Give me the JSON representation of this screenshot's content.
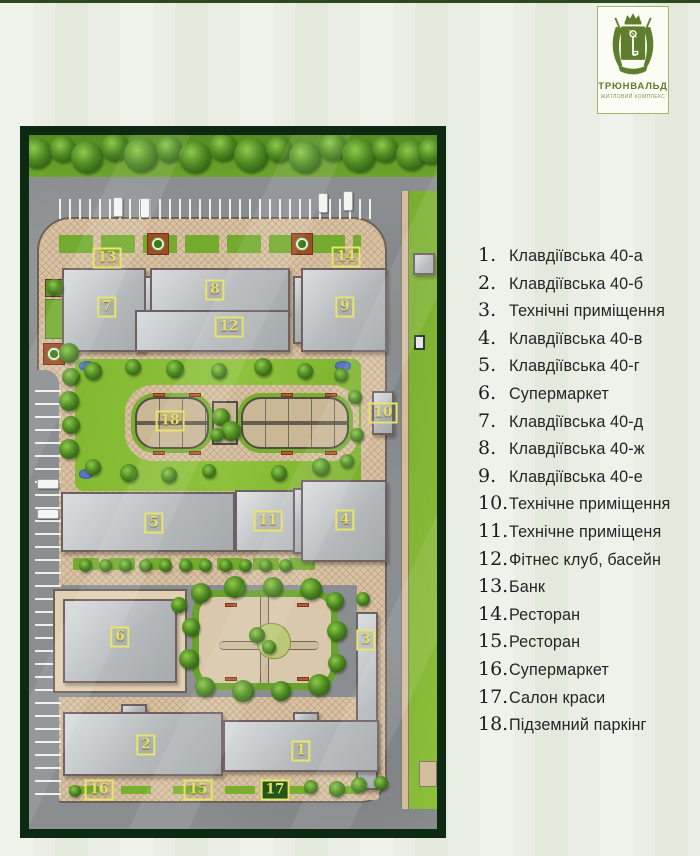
{
  "page": {
    "background": "#e9ede3",
    "top_line_color": "#2d4a1d"
  },
  "logo": {
    "title": "ТРЮНВАЛЬД",
    "subtitle": "ЖИТЛОВИЙ КОМПЛЕКС",
    "brand_color": "#5d7d2c",
    "crest_icon": "heraldic-crest-with-crown-and-key"
  },
  "map": {
    "frame_color": "#0d2912",
    "marker_color": "#e9e46a",
    "pavement_color": "#d8c2a3",
    "lawn_color": "#82b830",
    "road_color": "#8b8e90",
    "building_color": "#b8bcbe",
    "markers": [
      {
        "n": "1",
        "x": 272,
        "y": 616,
        "filled": false
      },
      {
        "n": "2",
        "x": 117,
        "y": 610,
        "filled": false
      },
      {
        "n": "3",
        "x": 337,
        "y": 505,
        "filled": false
      },
      {
        "n": "4",
        "x": 316,
        "y": 385,
        "filled": false
      },
      {
        "n": "5",
        "x": 125,
        "y": 388,
        "filled": false
      },
      {
        "n": "6",
        "x": 91,
        "y": 502,
        "filled": false
      },
      {
        "n": "7",
        "x": 78,
        "y": 172,
        "filled": false
      },
      {
        "n": "8",
        "x": 186,
        "y": 155,
        "filled": false
      },
      {
        "n": "9",
        "x": 316,
        "y": 172,
        "filled": false
      },
      {
        "n": "10",
        "x": 354,
        "y": 278,
        "filled": false
      },
      {
        "n": "11",
        "x": 239,
        "y": 386,
        "filled": false
      },
      {
        "n": "12",
        "x": 200,
        "y": 192,
        "filled": false
      },
      {
        "n": "13",
        "x": 78,
        "y": 123,
        "filled": false
      },
      {
        "n": "14",
        "x": 317,
        "y": 122,
        "filled": false
      },
      {
        "n": "15",
        "x": 169,
        "y": 655,
        "filled": false
      },
      {
        "n": "16",
        "x": 70,
        "y": 655,
        "filled": false
      },
      {
        "n": "17",
        "x": 246,
        "y": 655,
        "filled": true
      },
      {
        "n": "18",
        "x": 141,
        "y": 286,
        "filled": false
      }
    ]
  },
  "legend": {
    "items": [
      {
        "num": "1.",
        "label": "Клавдіївська 40-а"
      },
      {
        "num": "2.",
        "label": "Клавдіївська 40-б"
      },
      {
        "num": "3.",
        "label": "Технічні приміщення"
      },
      {
        "num": "4.",
        "label": "Клавдіївська 40-в"
      },
      {
        "num": "5.",
        "label": "Клавдіївська 40-г"
      },
      {
        "num": "6.",
        "label": "Супермаркет"
      },
      {
        "num": "7.",
        "label": "Клавдіївська 40-д"
      },
      {
        "num": "8.",
        "label": "Клавдіївська 40-ж"
      },
      {
        "num": "9.",
        "label": "Клавдіївська 40-е"
      },
      {
        "num": "10.",
        "label": "Технічне приміщення"
      },
      {
        "num": "11.",
        "label": "Технічне приміщеня"
      },
      {
        "num": "12.",
        "label": "Фітнес клуб, басейн"
      },
      {
        "num": "13.",
        "label": "Банк"
      },
      {
        "num": "14.",
        "label": "Ресторан"
      },
      {
        "num": "15.",
        "label": "Ресторан"
      },
      {
        "num": "16.",
        "label": "Супермаркет"
      },
      {
        "num": "17.",
        "label": "Салон краси"
      },
      {
        "num": "18.",
        "label": "Підземний паркінг"
      }
    ]
  }
}
